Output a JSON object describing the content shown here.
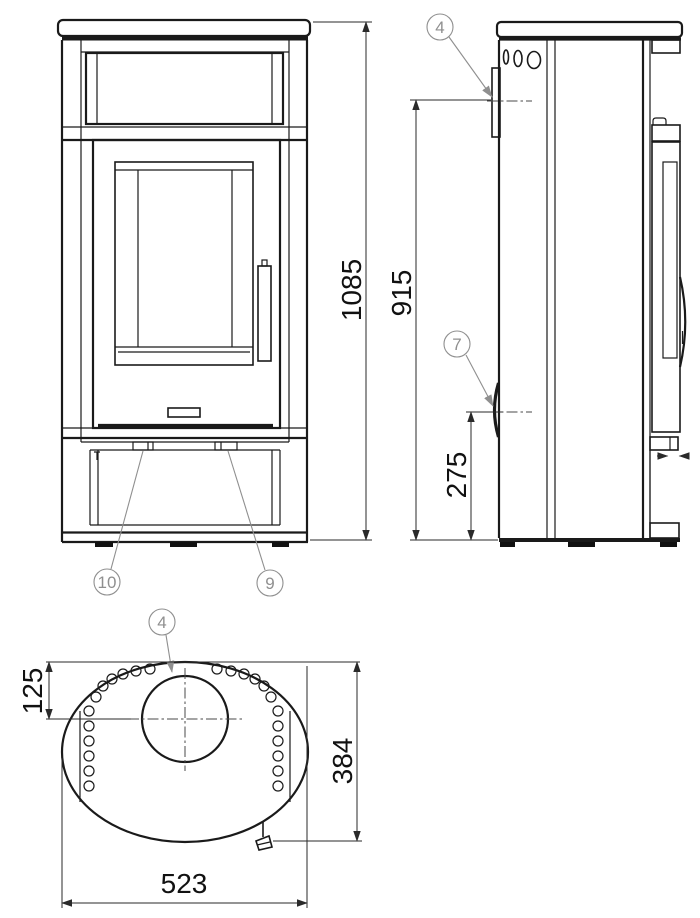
{
  "drawing": {
    "background": "#ffffff",
    "line_color": "#1a1a1a",
    "dimension_color": "#2a2a2a",
    "callout_color": "#8f8f8f",
    "dimensions": {
      "overall_height": "1085",
      "rear_outlet_height": "915",
      "side_inlet_height": "275",
      "flue_top_offset": "125",
      "depth": "384",
      "width": "523"
    },
    "callouts": {
      "side_rear_outlet": "4",
      "side_inlet": "7",
      "front_left_tab": "10",
      "front_right_tab": "9",
      "top_flue": "4"
    }
  }
}
